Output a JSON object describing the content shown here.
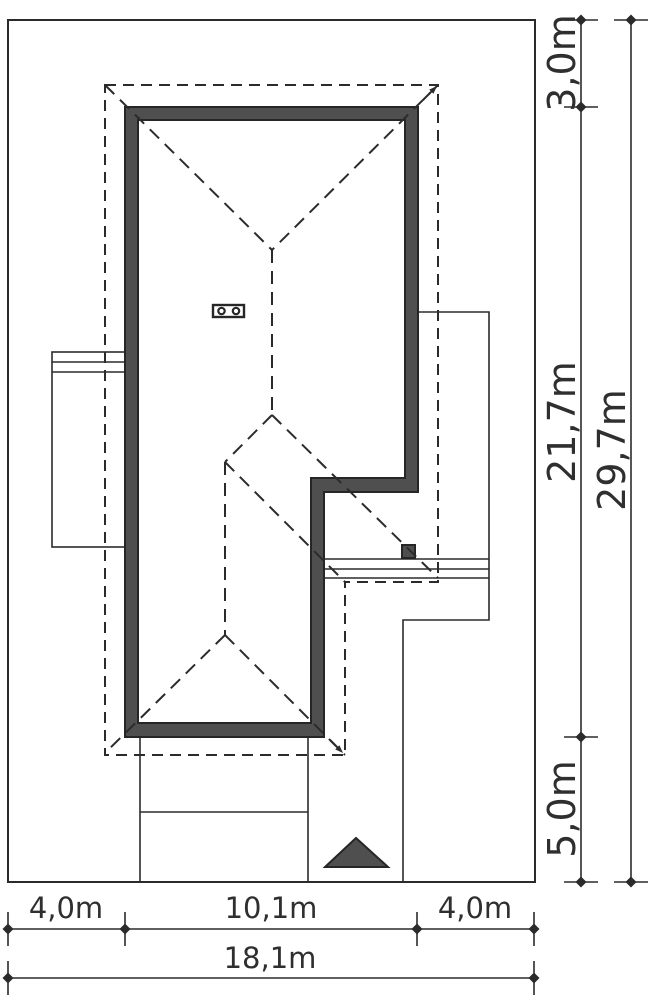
{
  "drawing": {
    "type": "architectural-site-plan",
    "units": "m",
    "colors": {
      "line": "#2b2b2b",
      "wall_fill": "#4f4f4f",
      "background": "#ffffff",
      "text": "#2f2f2f"
    },
    "dims_right": [
      {
        "name": "front-setback",
        "label": "3,0m"
      },
      {
        "name": "house-length",
        "label": "21,7m"
      },
      {
        "name": "rear-setback",
        "label": "5,0m"
      },
      {
        "name": "plot-depth",
        "label": "29,7m"
      }
    ],
    "dims_bottom": [
      {
        "name": "left-setback",
        "label": "4,0m"
      },
      {
        "name": "house-width",
        "label": "10,1m"
      },
      {
        "name": "right-setback",
        "label": "4,0m"
      },
      {
        "name": "plot-width",
        "label": "18,1m"
      }
    ],
    "symbols": {
      "entrance_arrow": "filled-triangle",
      "chimney": "rectangle-with-two-circles",
      "roof_slope_arrows": "diagonal-arrows-at-eave-corners",
      "roof_lines": "dashed-hips-and-ridges",
      "walls": "dark-band-outline"
    }
  }
}
